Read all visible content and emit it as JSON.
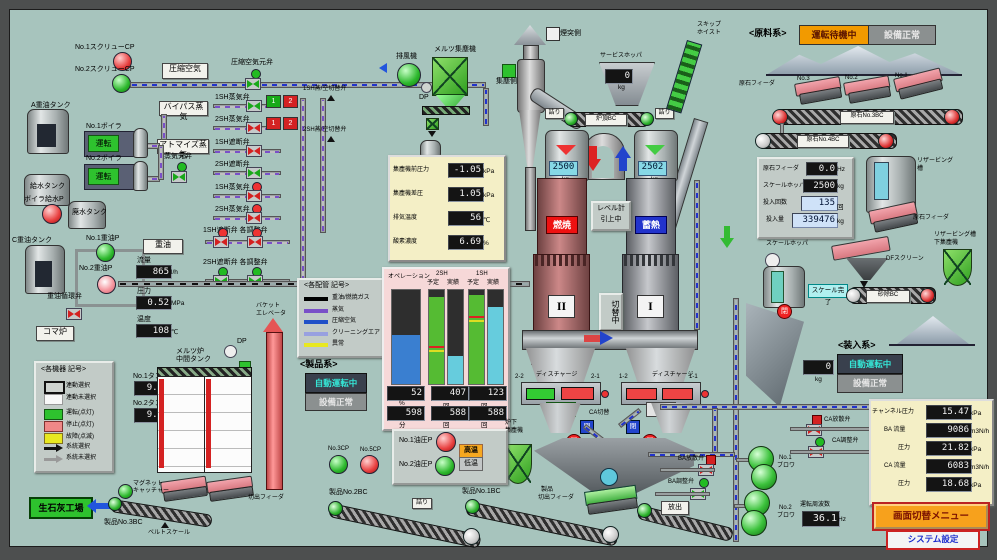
{
  "topleft": {
    "cp1": "No.1スクリューCP",
    "cp2": "No.2スクリューCP",
    "comp_air": "圧縮空気",
    "comp_air_valve": "圧縮空気元弁",
    "sw1": "1SH蒸/空切替弁",
    "sw2": "2SH蒸/空切替弁",
    "bypass": "バイパス蒸気",
    "atomize": "アトマイズ蒸気",
    "steam_main": "蒸気元弁",
    "rows": [
      {
        "label": "1SH蒸気弁",
        "b1": "1",
        "b2": "2"
      },
      {
        "label": "2SH蒸気弁",
        "b1": "1",
        "b2": "2"
      },
      {
        "label": "1SH遮断弁"
      },
      {
        "label": "2SH遮断弁"
      },
      {
        "label": "1SH蒸気弁"
      },
      {
        "label": "2SH蒸気弁"
      },
      {
        "label": "1SH遮断弁 各調整弁"
      },
      {
        "label": "2SH遮断弁 各調整弁"
      }
    ]
  },
  "boiler": {
    "a_tank": "A重油タンク",
    "b1": "No.1ボイラ",
    "b2": "No.2ボイラ",
    "run": "運転",
    "feed_tank": "給水タンク",
    "feed_pump": "ボイラ給水P",
    "waste_tank": "廃水タンク"
  },
  "oil": {
    "tank": "C重油タンク",
    "p1": "No.1重油P",
    "p2": "No.2重油P",
    "heavy": "重油",
    "flow_l": "流量",
    "flow": "865",
    "flow_u": "l/h",
    "pres_l": "圧力",
    "pres": "0.52",
    "pres_u": "MPa",
    "temp_l": "温度",
    "temp": "108",
    "temp_u": "℃",
    "circ": "重油循環弁",
    "koma": "コマ炉"
  },
  "eq_legend": {
    "title": "<各機器 記号>",
    "i0": "連動選択",
    "i1": "連動未選択",
    "i2": "運転(点灯)",
    "i3": "停止(点灯)",
    "i4": "故障(点滅)",
    "i5": "系統選択",
    "i6": "系統未選択"
  },
  "pipe_legend": {
    "title": "<各配管 記号>",
    "i0": "重油/燃焼ガス",
    "i1": "蒸気",
    "i2": "圧縮空気",
    "i3": "クリーニングエア",
    "i4": "異常"
  },
  "mid": {
    "title1": "メルツ炉",
    "title2": "中間タンク",
    "t1": "No.1タンク",
    "t1v": "9.0",
    "t2": "No.2タンク",
    "t2v": "9.0",
    "m": "m",
    "no1": "No.1",
    "no2": "No.2",
    "dp": "DP",
    "feeder": "切出フィーダ",
    "magnet1": "マグネット",
    "magnet2": "キャッチャー",
    "factory": "生石灰工場",
    "bc3": "製品No.3BC",
    "scale": "ベルトスケール",
    "bucket1": "バケット",
    "bucket2": "エレベータ"
  },
  "dust": {
    "fan": "排風機",
    "collector": "メルツ集塵機",
    "dp": "DP",
    "chimney": "煙突側",
    "collect": "集塵側",
    "r0l": "集塵機前圧力",
    "r0v": "-1.05",
    "r0u": "kPa",
    "r1l": "集塵機差圧",
    "r1v": "1.05",
    "r1u": "kPa",
    "r2l": "排気温度",
    "r2v": "56",
    "r2u": "℃",
    "r3l": "酸素濃度",
    "r3v": "6.69",
    "r3u": "%"
  },
  "ops": {
    "plan": "予定",
    "act": "実績"
  },
  "kiln": {
    "svc": "サービスホッパ",
    "svc_v": "0",
    "kg": "kg",
    "top_bc": "炉頂BC",
    "jam": "詰り",
    "skip1": "スキップ",
    "skip2": "ホイスト",
    "w2": "2500",
    "w1": "2502",
    "burn": "燃焼",
    "store": "蓄熱",
    "lvl1": "レベル計",
    "lvl2": "引上中",
    "switch": "切替中",
    "n2": "II",
    "n1": "I",
    "blaster": "エアブラスタ",
    "dis": "ディスチャージ",
    "p22": "2-2",
    "p21": "2-1",
    "p12": "1-2",
    "p11": "1-1",
    "slow": "低速",
    "stop": "停止",
    "ca_sw": "CA切替",
    "close": "閉",
    "under1": "炉下",
    "under2": "集塵機",
    "pf1": "製品",
    "pf2": "切出フィーダ"
  },
  "raw": {
    "title": "<原料系>",
    "standby": "運転待機中",
    "normal": "設備正常",
    "feeders": "原石フィーダ",
    "n3": "No.3",
    "n2": "No.2",
    "n1": "No.1",
    "bc3": "原石No.3BC",
    "bc4": "原石No.4BC",
    "r0l": "原石フィーダ",
    "r0v": "0.0",
    "r0u": "Hz",
    "r1l": "スケールホッパ",
    "r1v": "2500",
    "r1u": "kg",
    "r2l": "投入回数",
    "r2v": "135",
    "r2u": "回",
    "r3l": "投入量",
    "r3v": "339476",
    "r3u": "kg",
    "resv1": "リザービング",
    "resv2": "槽",
    "feeder2": "原石フィーダ",
    "df": "DFスクリーン",
    "dust1": "リザービング槽",
    "dust2": "下集塵機",
    "scale_hopper": "スケールホッパ",
    "scale_done": "スケール完了",
    "sand_bc": "砂除BC"
  },
  "charge": {
    "title": "<装入系>",
    "auto": "自動運転中",
    "normal": "設備正常",
    "w": "0",
    "kg": "kg",
    "close": "閉",
    "ca_rel": "CA放散弁",
    "ca_adj": "CA調整弁",
    "ba_rel": "BA放散弁",
    "ba_adj": "BA調整弁",
    "release": "放出",
    "bl1a": "No.1",
    "bl1b": "ブロワ",
    "bl2a": "No.2",
    "bl2b": "ブロワ",
    "freq_l": "運転周波数",
    "freq": "36.1",
    "freq_u": "Hz",
    "r0l": "チャンネル圧力",
    "r0v": "15.47",
    "r0u": "kPa",
    "r1l": "BA 流量",
    "r1v": "9086",
    "r1u": "m3N/h",
    "r2l": "圧力",
    "r2v": "21.82",
    "r2u": "kPa",
    "r3l": "CA 流量",
    "r3v": "6083",
    "r3u": "m3N/h",
    "r4l": "圧力",
    "r4v": "18.68",
    "r4u": "kPa"
  },
  "prod": {
    "title": "<製品系>",
    "auto": "自動運転中",
    "normal": "設備正常",
    "op1": "No.1油圧P",
    "op2": "No.2油圧P",
    "hot": "高温",
    "cold": "低温",
    "cp3": "No.3CP",
    "cp5": "No.5CP",
    "bc2": "製品No.2BC",
    "bc1": "製品No.1BC",
    "jam": "詰り"
  },
  "btns": {
    "menu": "画面切替メニュー",
    "sys": "システム設定"
  },
  "chart_data": {
    "type": "bar",
    "title": "オペレーション / 2SH / 1SH 予定・実績",
    "ylim": [
      0,
      100
    ],
    "grid": false,
    "legend_position": "top",
    "groups": [
      {
        "name": "オペレーション",
        "bars": [
          {
            "label": "オペレーション",
            "pct": 52,
            "color": "#3a7fd0"
          }
        ],
        "top_value": "52",
        "top_unit": "%",
        "bottom_value": "598",
        "bottom_unit": "分"
      },
      {
        "name": "2SH",
        "bars": [
          {
            "label": "予定",
            "pct": 93,
            "color": "#55bb33"
          },
          {
            "label": "実績",
            "pct": 30,
            "color": "#66ccdd"
          }
        ],
        "top_value": "407",
        "top_unit": "回",
        "bottom_value": "588",
        "bottom_unit": "回"
      },
      {
        "name": "1SH",
        "bars": [
          {
            "label": "予定",
            "pct": 95,
            "color": "#55bb33"
          },
          {
            "label": "実績",
            "pct": 82,
            "color": "#66ccdd"
          }
        ],
        "top_value": "123",
        "top_unit": "回",
        "bottom_value": "588",
        "bottom_unit": "回"
      }
    ]
  }
}
